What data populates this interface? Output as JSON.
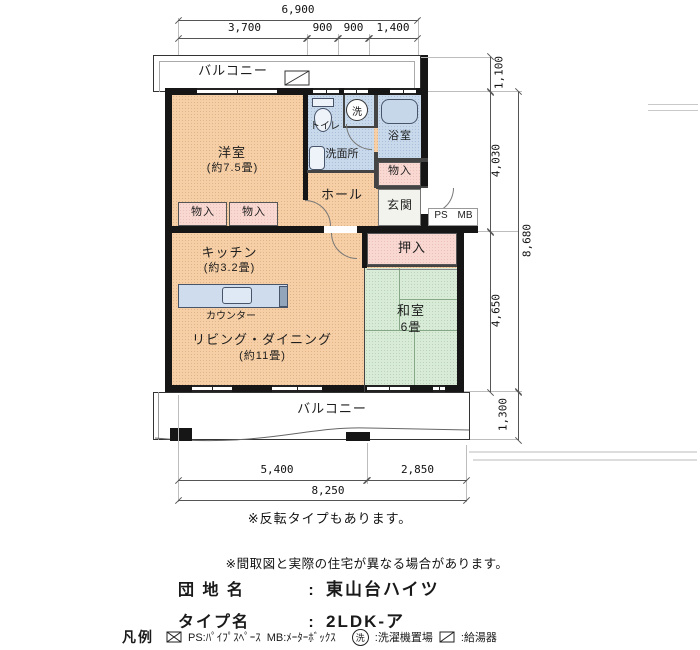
{
  "dims": {
    "top_total": "6,900",
    "top_segments": [
      "3,700",
      "900",
      "900",
      "1,400"
    ],
    "right_balcony_top": "1,100",
    "right_upper": "4,030",
    "right_total": "8,680",
    "right_lower": "4,650",
    "right_balcony_bottom": "1,300",
    "bottom_segments": [
      "5,400",
      "2,850"
    ],
    "bottom_total": "8,250"
  },
  "rooms": {
    "balcony_top": "バルコニー",
    "balcony_bottom": "バルコニー",
    "western": "洋室",
    "western_size": "(約7.5畳)",
    "toilet": "トイレ",
    "washer": "洗",
    "bath": "浴室",
    "washroom": "洗面所",
    "storage_bath": "物入",
    "storage_left": "物入",
    "storage_right": "物入",
    "hall": "ホール",
    "entrance": "玄関",
    "ps": "PS",
    "mb": "MB",
    "kitchen": "キッチン",
    "kitchen_size": "(約3.2畳)",
    "counter": "カウンター",
    "living": "リビング・ダイニング",
    "living_size": "(約11畳)",
    "closet": "押入",
    "japanese": "和室",
    "japanese_size": "6畳"
  },
  "notes": {
    "flip": "※反転タイプもあります。",
    "disclaimer": "※間取図と実際の住宅が異なる場合があります。"
  },
  "title": {
    "estate_label": "団 地 名",
    "colon1": ":",
    "estate_name": "東山台ハイツ",
    "type_label": "タイプ名",
    "colon2": ":",
    "type_name": "2LDK-ア"
  },
  "legend": {
    "heading": "凡例",
    "ps_desc": "PS:ﾊﾟｲﾌﾟｽﾍﾟｰｽ",
    "mb_desc": "MB:ﾒｰﾀｰﾎﾞｯｸｽ",
    "washer_symbol": "洗",
    "washer_desc": ":洗濯機置場",
    "heater_desc": ":給湯器"
  },
  "colors": {
    "room": "#f6cfa6",
    "wet_area": "#c9d9ec",
    "closet": "#f9d8d2",
    "tatami": "#d7ebd6",
    "wall": "#161616"
  }
}
